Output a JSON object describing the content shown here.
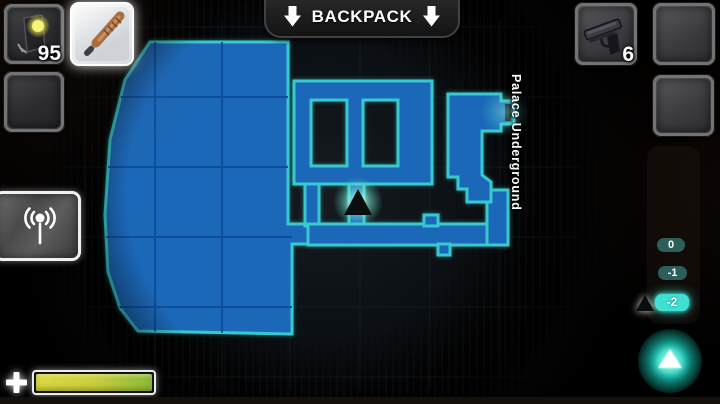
{
  "hud": {
    "backpack_banner": {
      "label": "BACKPACK",
      "left_icon": "down-arrow",
      "right_icon": "down-arrow"
    },
    "left_inventory": {
      "slot1": {
        "item": "flashlight",
        "count": "95"
      },
      "slot2": {
        "item": "cricket-bat",
        "selected": true
      },
      "slot3": {
        "item": ""
      }
    },
    "right_inventory": {
      "slot1": {
        "item": "pistol",
        "count": "6"
      },
      "slot2": {
        "item": ""
      },
      "slot3": {
        "item": ""
      }
    },
    "radio_button": {
      "icon": "antenna"
    },
    "floor_selector": {
      "levels": [
        {
          "label": "0",
          "active": false
        },
        {
          "label": "-1",
          "active": false
        },
        {
          "label": "-2",
          "active": true
        }
      ],
      "marker": "player-floor-triangle"
    },
    "ascend_button": {
      "icon": "up-triangle"
    },
    "health_bar": {
      "icon": "plus",
      "fill_percent": 97
    }
  },
  "map": {
    "location_label": "Palace Underground",
    "player_marker": "triangle-up",
    "colors": {
      "room_fill": "#1a67b8",
      "room_outline": "#38c8cf",
      "grid_line": "#0d4f9b",
      "player_glow": "#9df5e6"
    }
  }
}
